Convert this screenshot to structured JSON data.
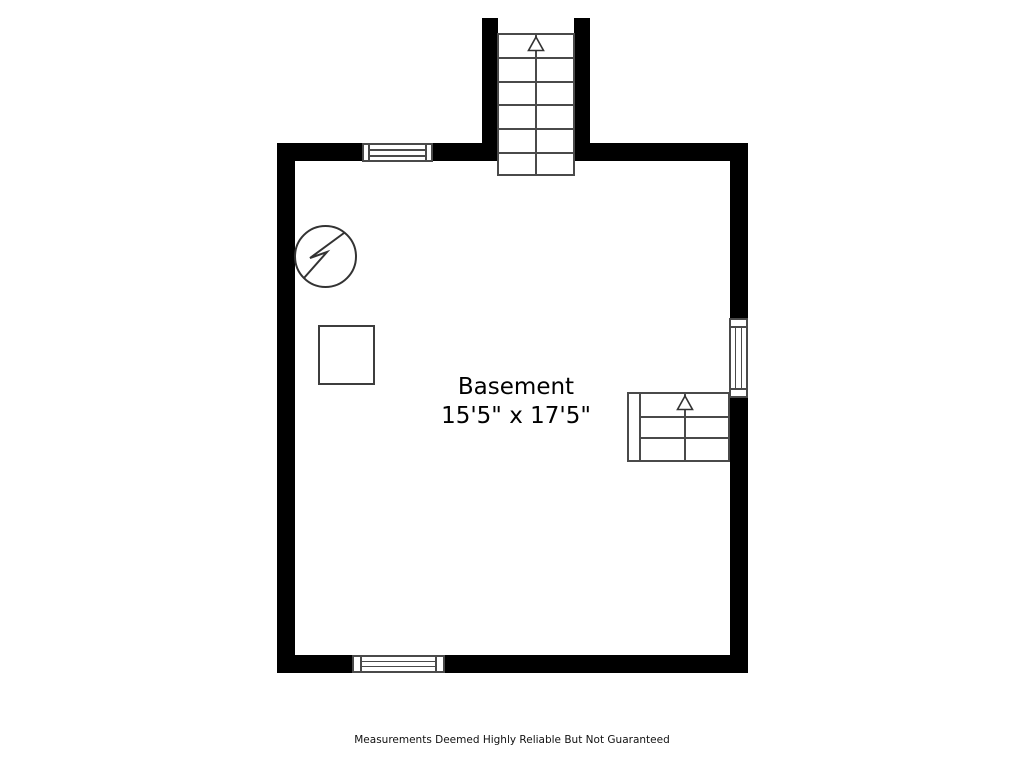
{
  "floorplan": {
    "room": {
      "name": "Basement",
      "dimensions": "15'5\" x 17'5\""
    },
    "footer": {
      "disclaimer": "Measurements Deemed Highly Reliable But Not Guaranteed"
    },
    "colors": {
      "wall": "#000000",
      "thin_line": "#4a4a4a",
      "text": "#000000",
      "background": "#ffffff"
    },
    "symbols": [
      {
        "name": "electrical-panel-icon",
        "glyph": "circle-with-lightning-bolt"
      },
      {
        "name": "utility-box-symbol",
        "glyph": "square-outline"
      },
      {
        "name": "stairs-up-arrow-icon",
        "glyph": "open-triangle-arrow-up",
        "count": 2
      }
    ],
    "features": {
      "windows": [
        "top-wall-window",
        "bottom-wall-window",
        "right-wall-window"
      ],
      "staircases": [
        "upper-staircase-exterior-top",
        "lower-staircase-interior-right"
      ]
    }
  }
}
